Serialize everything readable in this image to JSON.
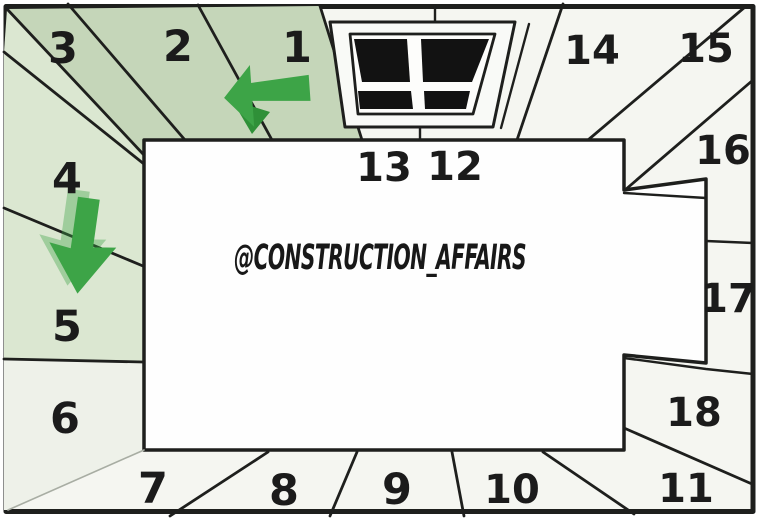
{
  "diagram": {
    "watermark_text": "@CONSTRUCTION_AFFAIRS",
    "segment_labels": [
      "1",
      "2",
      "3",
      "4",
      "5",
      "6",
      "7",
      "8",
      "9",
      "10",
      "11",
      "12",
      "13",
      "14",
      "15",
      "16",
      "17",
      "18"
    ],
    "icons": [
      {
        "name": "green-arrow-left-icon",
        "direction": "left"
      },
      {
        "name": "green-arrow-down-icon",
        "direction": "down"
      },
      {
        "name": "window",
        "panes": 4
      }
    ],
    "colors": {
      "ring_base": "#f5f6f1",
      "band_green": "#c5d6b9",
      "band_light_green": "#dbe7d1",
      "band_pale": "#eef1e9",
      "room_white": "#fefefe",
      "line_dark": "#1e1f1d",
      "pane_black": "#121212",
      "arrow_green": "#3da447",
      "arrow_green_dark": "#2f9038",
      "joint_gray": "#a8ada3",
      "frame_white": "#f9faf7"
    }
  }
}
